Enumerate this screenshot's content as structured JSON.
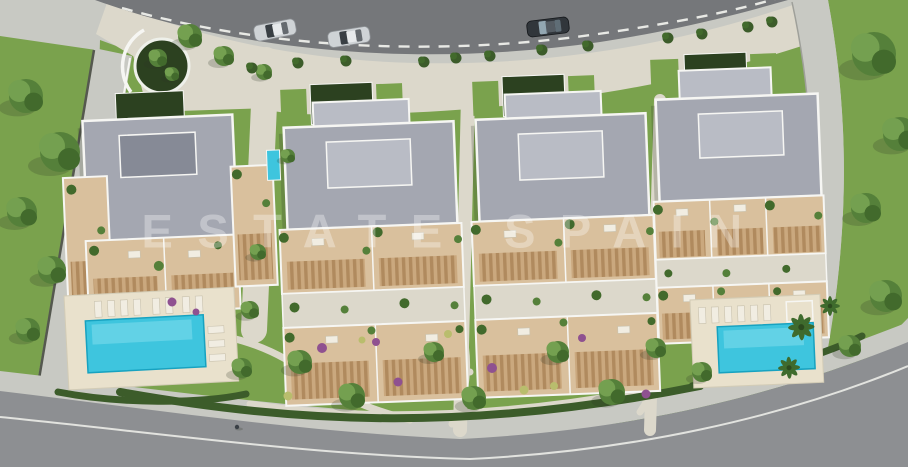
{
  "watermark": {
    "text": "ESTATE SPAIN"
  },
  "scene": {
    "kind": "aerial 3d architectural render",
    "subject": "residential development site plan",
    "buildings": [
      "block-1",
      "block-2",
      "block-3",
      "block-4"
    ],
    "pools": 2,
    "cars": [
      {
        "color": "silver"
      },
      {
        "color": "silver"
      },
      {
        "color": "dark"
      }
    ],
    "roads": {
      "top": "two-lane road with dashed centerline",
      "bottom": "curved perimeter road with solid edge line"
    }
  },
  "colors": {
    "road": "#75777a",
    "roadBottom": "#8d8f92",
    "lane": "#e8e9e5",
    "pave": "#c8c9c3",
    "paveWarm": "#dcd8cb",
    "paveEdge": "#9fa09a",
    "grass": "#7aa24d",
    "grassDark": "#648c3e",
    "hedge": "#3c5c2a",
    "court": "#2c4120",
    "tree1": "#55803a",
    "tree2": "#426a2c",
    "tree3": "#74a050",
    "palm": "#3f6b2d",
    "roof": "#a4a7b1",
    "roofLight": "#b9bcc5",
    "roofDark": "#868a96",
    "white": "#f6f6f3",
    "terrace": "#d9c09d",
    "terraceDark": "#caa87e",
    "wood": "#b08a5e",
    "deck": "#e9e1cc",
    "pool": "#3ec5de",
    "poolLight": "#8fe2ef",
    "poolEdge": "#17a2c0",
    "flowerPurple": "#8f5190",
    "flowerYellow": "#b9bd6d",
    "carSilver": "#cfd3d6",
    "carDark": "#31363b",
    "glass": "#1e242a",
    "shadow": "rgba(45,55,35,0.22)"
  }
}
